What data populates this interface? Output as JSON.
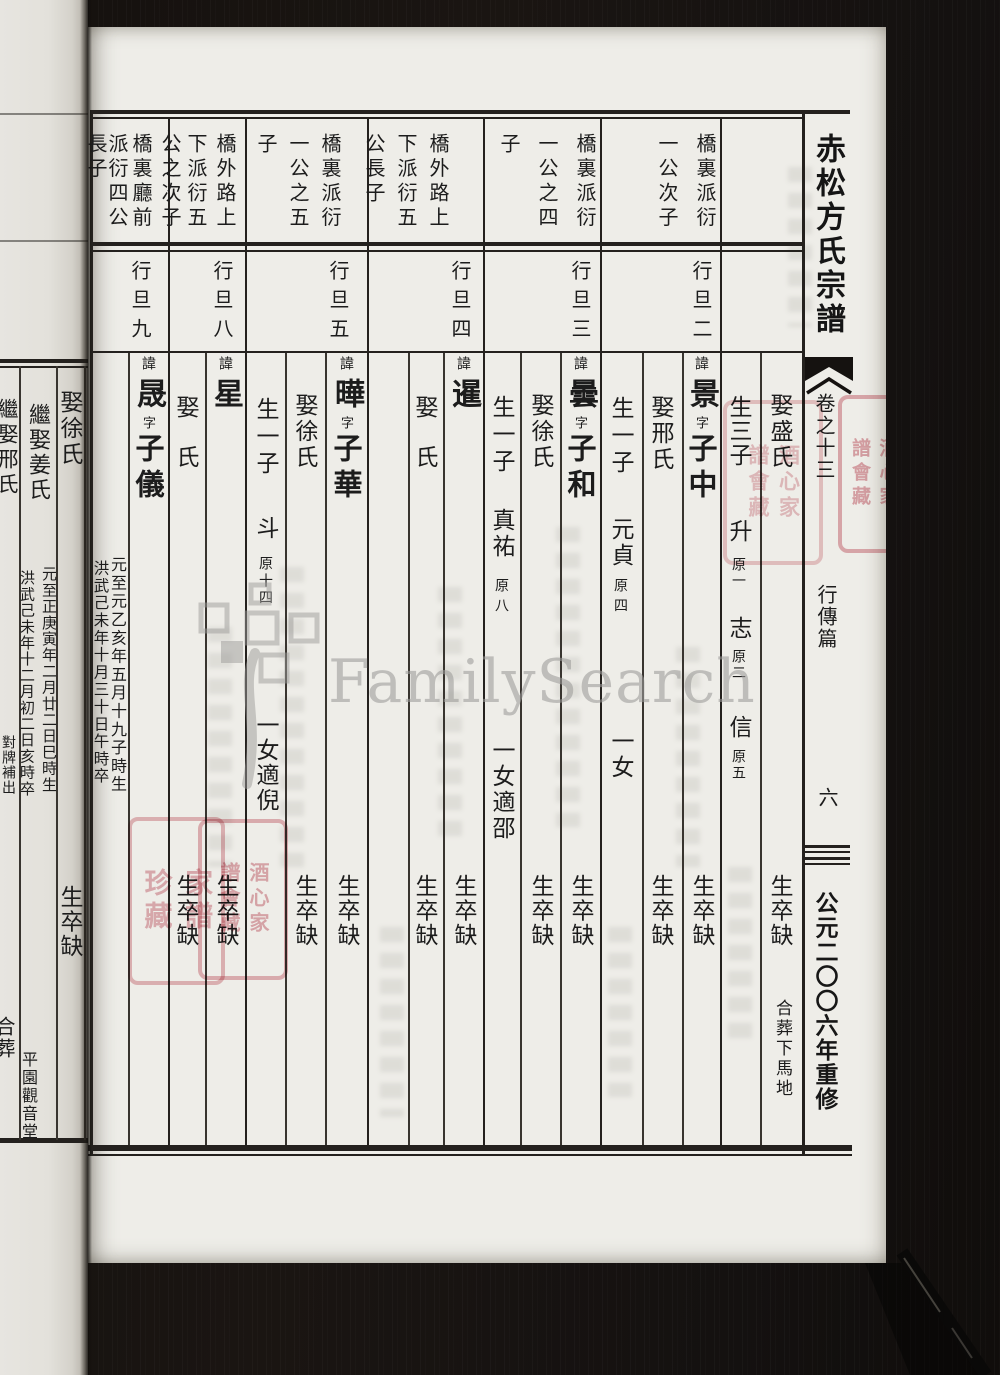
{
  "sidebar": {
    "book_title": "赤松方氏宗譜",
    "volume": "卷之十三",
    "section": "行傳篇",
    "folio": "六",
    "edition": "公元二〇〇六年重修"
  },
  "watermark": {
    "text": "FamilySearch"
  },
  "headers": [
    {
      "line1": "橋裏派衍",
      "line2": "一公次子",
      "line3": "",
      "rank": "行旦二"
    },
    {
      "line1": "橋裏派衍",
      "line2": "一公之四",
      "line3": "子",
      "rank": "行旦三"
    },
    {
      "line1": "橋外路上",
      "line2": "下派衍五",
      "line3": "公長子",
      "rank": "行旦四"
    },
    {
      "line1": "橋裏派衍",
      "line2": "一公之五",
      "line3": "子",
      "rank": "行旦五"
    },
    {
      "line1": "橋外路上",
      "line2": "下派衍五",
      "line3": "公之次子",
      "rank": "行旦八"
    },
    {
      "line1": "橋裏廳前",
      "line2": "派衍四公",
      "line3": "長子",
      "rank": "行旦九"
    }
  ],
  "records": {
    "r0": {
      "spouse": "娶盛氏",
      "children_head": "生三子",
      "son1": "升",
      "son1_tag": "原一",
      "son2": "志",
      "son2_tag": "原二",
      "son3": "信",
      "son3_tag": "原五",
      "spouse_note": "生卒缺",
      "burial": "合葬下馬地"
    },
    "r1": {
      "hui": "諱",
      "name": "景",
      "zi": "字",
      "style": "子中",
      "spouse": "娶邢氏",
      "children_head": "生一子",
      "son": "元貞",
      "son_tag": "原四",
      "daughter": "一女",
      "name_note": "生卒缺",
      "spouse_note": "生卒缺"
    },
    "r2": {
      "hui": "諱",
      "name": "曇",
      "zi": "字",
      "style": "子和",
      "spouse": "娶徐氏",
      "children_head": "生一子",
      "son": "真祐",
      "son_tag": "原八",
      "daughter": "一女適邵",
      "name_note": "生卒缺",
      "spouse_note": "生卒缺"
    },
    "r3": {
      "hui": "諱",
      "name": "暹",
      "spouse": "娶　氏",
      "name_note": "生卒缺",
      "spouse_note": "生卒缺"
    },
    "r4": {
      "hui": "諱",
      "name": "曄",
      "zi": "字",
      "style": "子華",
      "spouse": "娶徐氏",
      "children_head": "生一子",
      "son": "斗",
      "son_tag": "原十四",
      "daughter": "一女適倪",
      "name_note": "生卒缺",
      "spouse_note": "生卒缺"
    },
    "r5": {
      "hui": "諱",
      "name": "星",
      "spouse": "娶　氏",
      "name_note": "生卒缺",
      "spouse_note": "生卒缺"
    },
    "r6": {
      "hui": "諱",
      "name": "晟",
      "zi": "字",
      "style": "子儀",
      "birth": "元至元乙亥年五月十九子時生",
      "death": "洪武己未年十月三十日午時卒"
    }
  },
  "margin": {
    "spouse": "娶徐氏",
    "spouse2": "繼娶姜氏",
    "spouse2_birth": "元至正庚寅年二月廿二日巳時生",
    "spouse2_death": "洪武己未年十二月初二日亥時卒",
    "spouse3": "繼娶邢氏",
    "note": "對牌補出",
    "missing": "生卒缺",
    "burial1": "合葬",
    "burial2": "平園觀音堂"
  },
  "seals": {
    "library": "酒心家\n譜會藏",
    "collection": "家譜\n珍藏"
  }
}
